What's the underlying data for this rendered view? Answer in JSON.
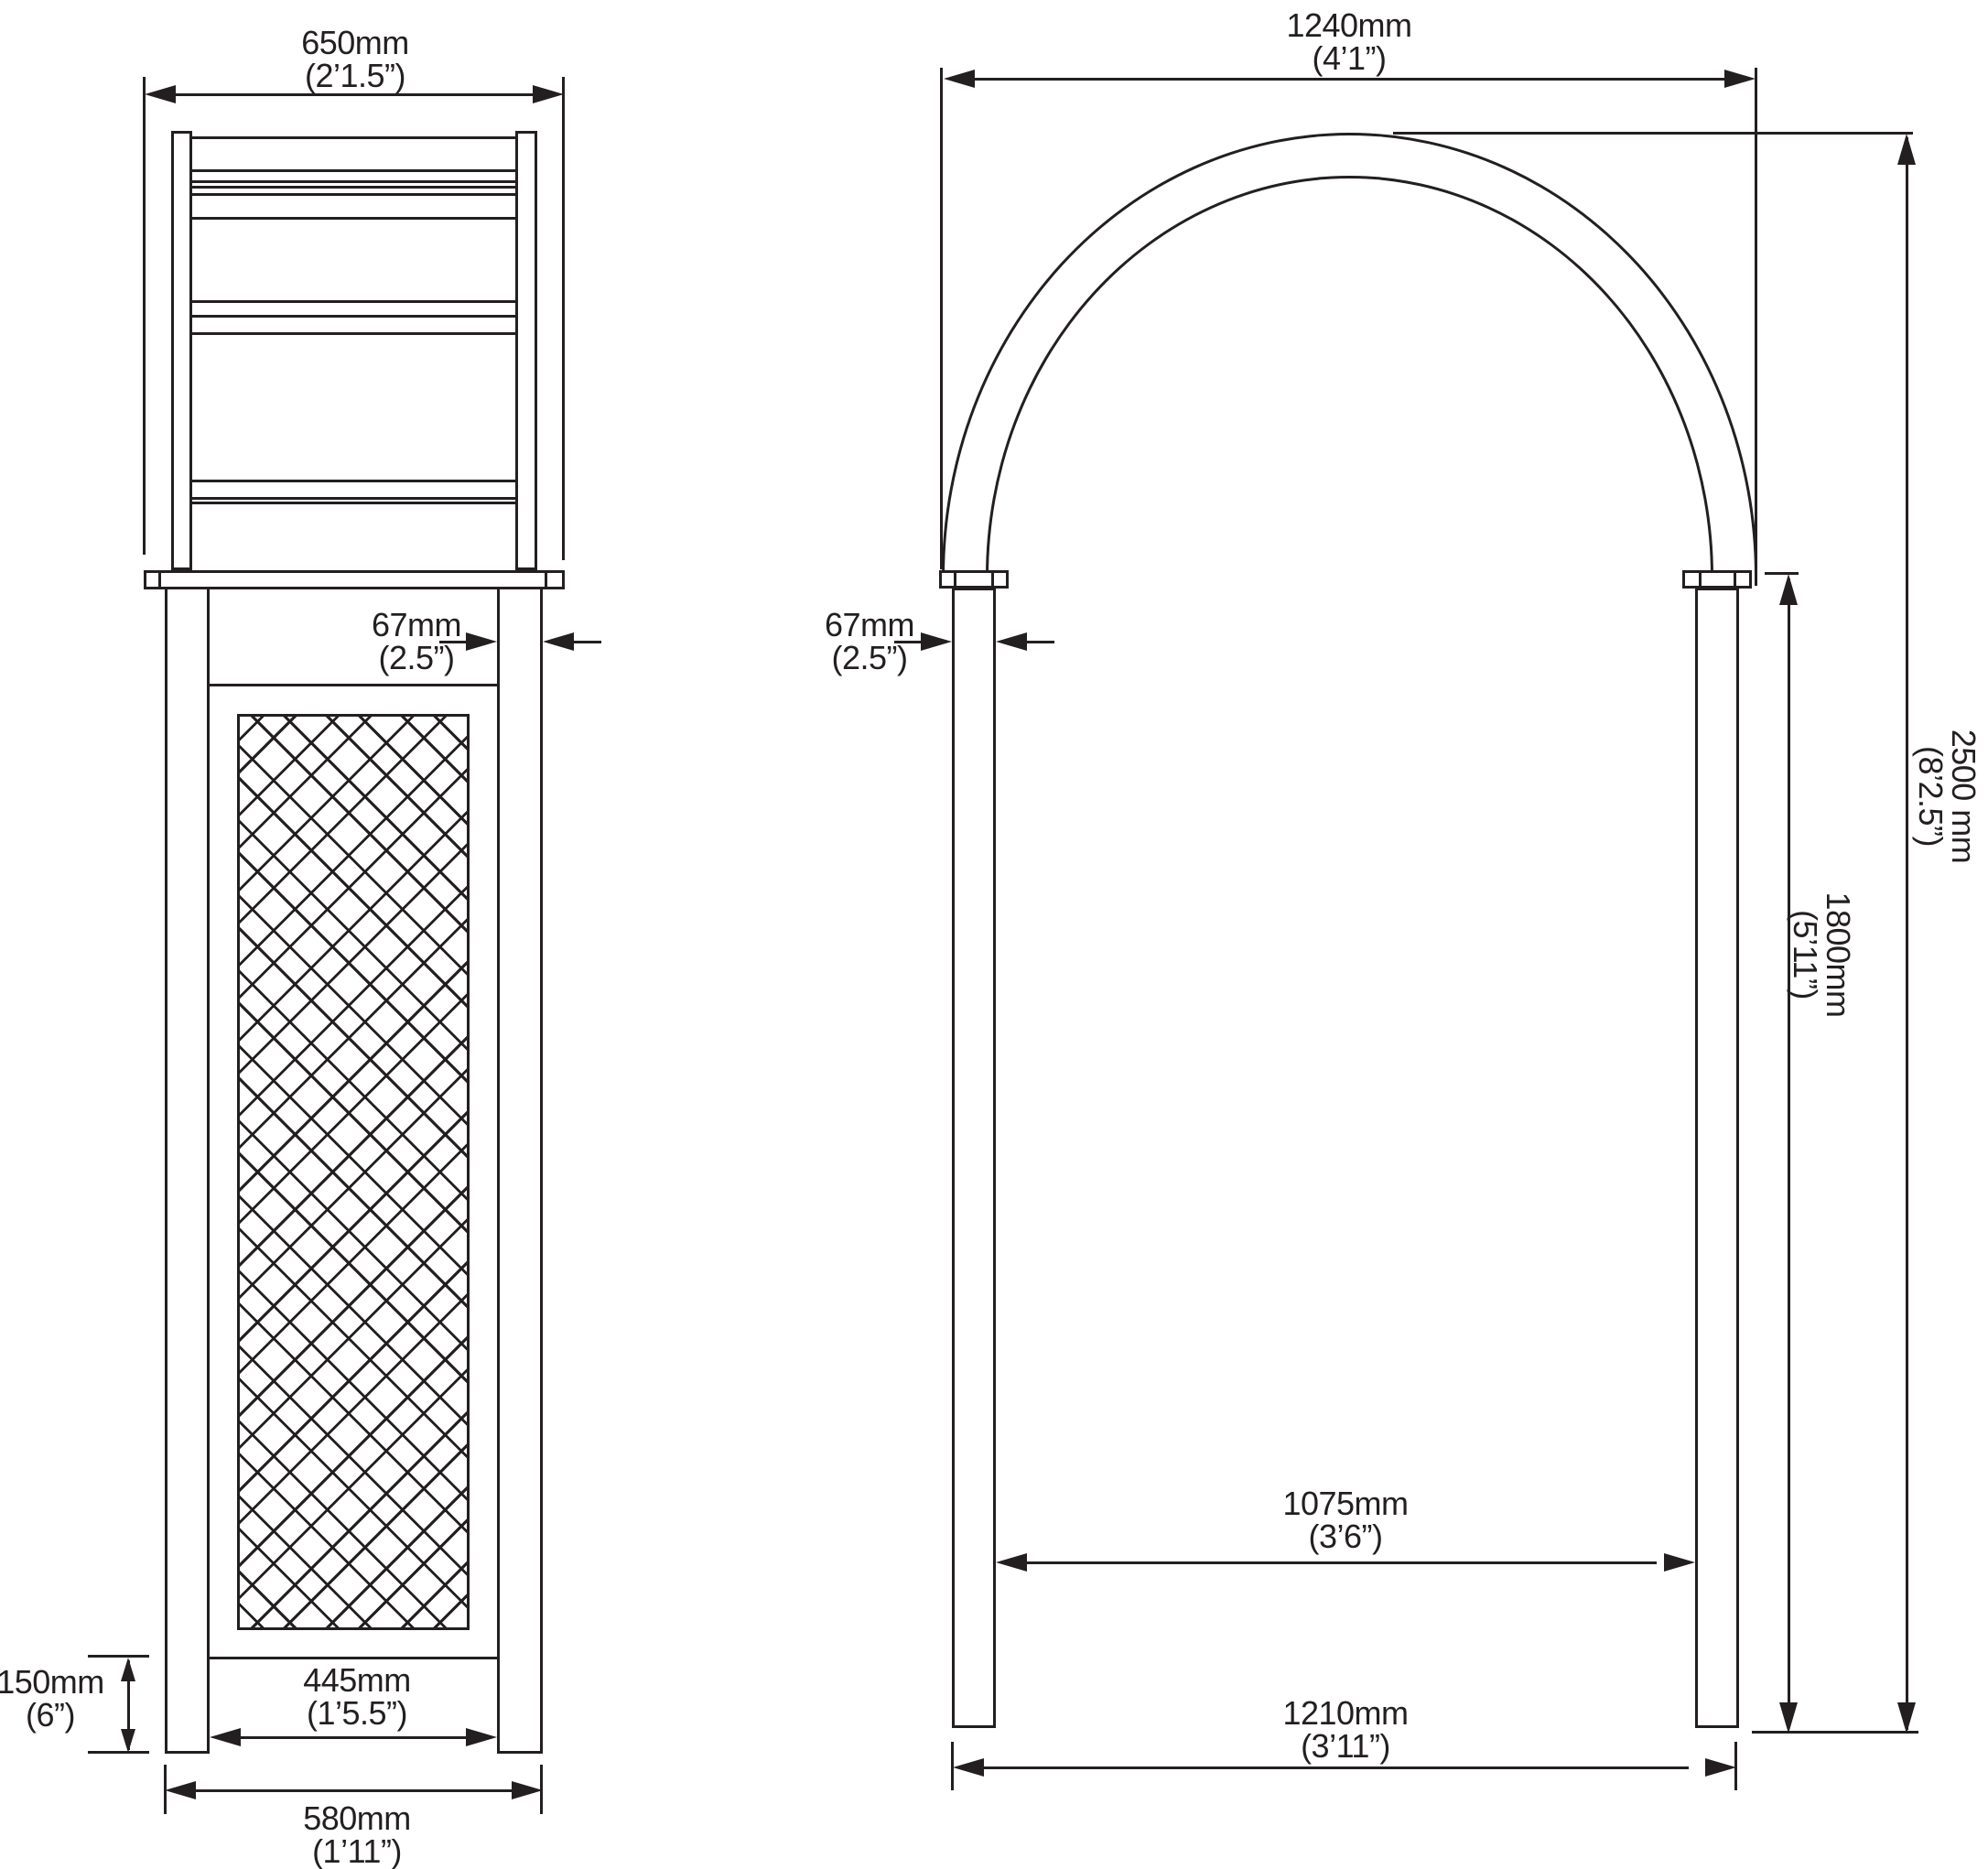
{
  "meta": {
    "drawing_type": "Dimensioned technical line drawing of a garden arch (side elevation and front elevation)",
    "line_color": "#231f20",
    "background_color": "#ffffff"
  },
  "side_view": {
    "name": "side elevation with lattice panel",
    "dim_overall_top_width": {
      "mm": "650mm",
      "imp": "(2’1.5”)"
    },
    "dim_post_width": {
      "mm": "67mm",
      "imp": "(2.5”)"
    },
    "dim_bottom_gap": {
      "mm": "150mm",
      "imp": "(6”)"
    },
    "dim_panel_inner_width": {
      "mm": "445mm",
      "imp": "(1’5.5”)"
    },
    "dim_base_outer_width": {
      "mm": "580mm",
      "imp": "(1’11”)"
    }
  },
  "front_view": {
    "name": "front elevation with arched top",
    "dim_arch_outer_width": {
      "mm": "1240mm",
      "imp": "(4’1”)"
    },
    "dim_post_width": {
      "mm": "67mm",
      "imp": "(2.5”)"
    },
    "dim_overall_height": {
      "mm": "2500 mm",
      "imp": "(8’2.5”)"
    },
    "dim_post_height": {
      "mm": "1800mm",
      "imp": "(5’11”)"
    },
    "dim_clear_inner_width": {
      "mm": "1075mm",
      "imp": "(3’6”)"
    },
    "dim_base_outer_width": {
      "mm": "1210mm",
      "imp": "(3’11”)"
    }
  }
}
